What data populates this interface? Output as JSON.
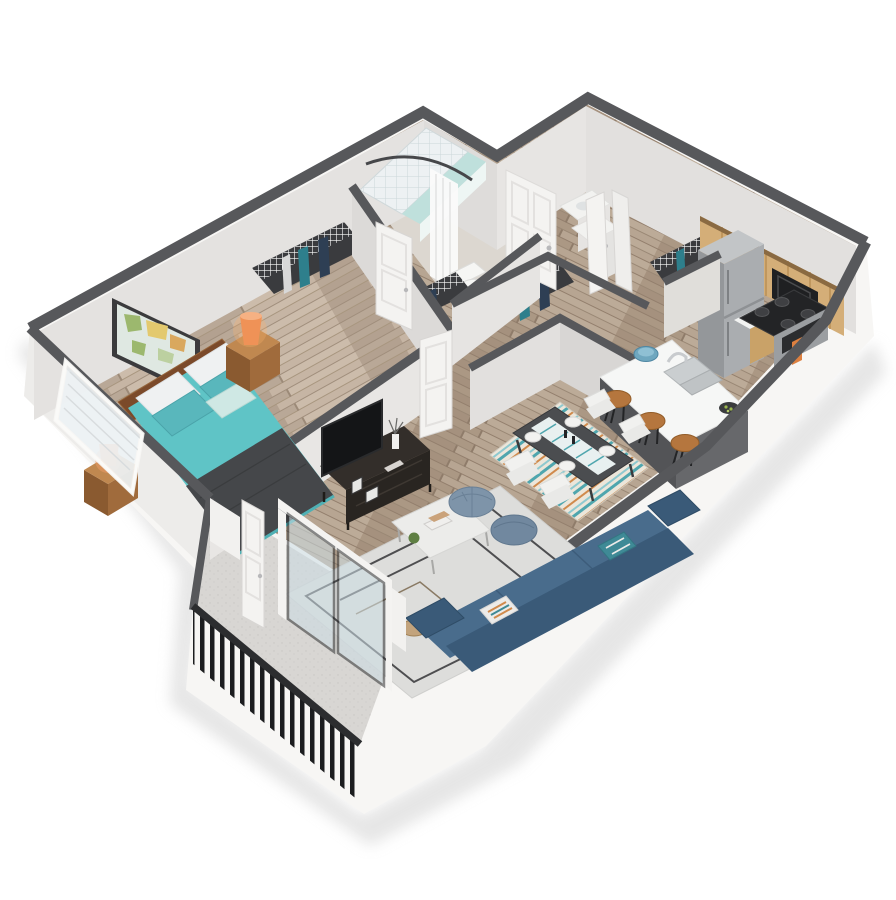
{
  "scene": {
    "title": "3D Floor Plan — One-Bedroom Apartment",
    "style": "isometric cutaway render, white background",
    "background": "#ffffff"
  },
  "palette": {
    "wall_top": "#57585b",
    "wall_interior": "#e3e1df",
    "wall_interior_shaded": "#d6d4d2",
    "wall_exterior": "#f7f6f4",
    "floor_wood": "#b4a190",
    "floor_wood_bedroom": "#c2b1a0",
    "floor_bath": "#dcd7d0",
    "floor_balcony": "#d8d6d3",
    "shadow": "#cdcdcd",
    "bed_teal": "#5fc4c6",
    "bed_blanket": "#45474a",
    "pillow_white": "#eff1f2",
    "pillow_teal": "#59b7bc",
    "pillow_mint": "#cfe8e4",
    "headboard_wood": "#7b4a2a",
    "nightstand_wood": "#c08850",
    "lamp_orange": "#ef9257",
    "map_frame": "#3b3b3d",
    "map_paper": "#dfe8e2",
    "map_land_green": "#9cb86e",
    "map_land_yellow": "#e3c96e",
    "closet_recess": "#3a3b3e",
    "clothes_teal": "#2e7f8c",
    "clothes_navy": "#2e3f54",
    "tile": "#edf1f3",
    "tub_teal": "#bfe0dc",
    "curtain_white": "#fafafa",
    "rod_dark": "#46474a",
    "toilet_white": "#f6f6f4",
    "door_white": "#f4f3f1",
    "door_edge": "#d8d6d4",
    "glass_blue": "#ccdde4",
    "glass_sash": "#2e2f31",
    "cabinet_wood": "#d4ae78",
    "cabinet_seam": "#b98f55",
    "fridge_steel": "#aaadb0",
    "fridge_side": "#94979a",
    "stove_black": "#232426",
    "stove_steel": "#9b9ea1",
    "towel_orange": "#dd8040",
    "microwave_black": "#1f2022",
    "counter_white": "#f6f7f6",
    "island_base": "#535457",
    "sink_gray": "#caced0",
    "bowl_blue": "#6fa7bf",
    "plate_dark": "#3a3c3e",
    "food_green": "#9cb84e",
    "stool_wood": "#b5763e",
    "dining_table": "#4b4d50",
    "chair_white": "#f1f1ef",
    "runner_white": "#e8f0f0",
    "rug_teal": "#4fa6ae",
    "rug_orange": "#d08a4c",
    "rug_cream": "#ece6da",
    "tv_black": "#141517",
    "console_espresso": "#332e2a",
    "coffee_table": "#ececea",
    "pouf_blue": "#7e94a9",
    "sofa_blue": "#496c8c",
    "sofa_blue_dark": "#3a5a78",
    "accent_teal": "#3f8a96",
    "rug_living": "#dddddb",
    "rug_lines": "#4e4e50",
    "rope_table": "#c2a37c",
    "railing_black": "#1c1d1f",
    "railing_cap": "#2c2d2f",
    "plant_green": "#5f7f43"
  },
  "rooms": [
    {
      "name": "bedroom",
      "contents": [
        "queen bed with teal bedding",
        "dark gray throw blanket",
        "wood headboard",
        "two wood nightstands",
        "orange table lamps",
        "framed world map",
        "reach-in closet with wire shelf and hanging clothes",
        "window with blinds"
      ]
    },
    {
      "name": "bathroom",
      "contents": [
        "tiled shower with white curtain and curved rod",
        "toilet",
        "vanity sink",
        "white six-panel door"
      ]
    },
    {
      "name": "hallway",
      "contents": [
        "walk-in closets with wire shelves",
        "coat closet",
        "washer-dryer nook with bifold doors",
        "entry door"
      ]
    },
    {
      "name": "kitchen",
      "contents": [
        "stainless refrigerator",
        "black range with orange towel",
        "built-in microwave",
        "light wood upper and lower cabinets",
        "prep counter with cutting board"
      ]
    },
    {
      "name": "dining",
      "contents": [
        "island with double sink, faucet, blue bowl and serving plate",
        "three wood bar stools",
        "dark dining table with striped runner and place settings",
        "four white chairs",
        "teal-orange striped rug"
      ]
    },
    {
      "name": "living room",
      "contents": [
        "blue sofa with patterned pillows",
        "two blue-gray ottoman poufs",
        "light gray coffee table with books and plant",
        "espresso TV console with television and decor",
        "geometric area rug",
        "rope side table",
        "sliding glass door"
      ]
    },
    {
      "name": "balcony",
      "contents": [
        "concrete floor",
        "black metal railing",
        "white hinged door"
      ]
    }
  ]
}
